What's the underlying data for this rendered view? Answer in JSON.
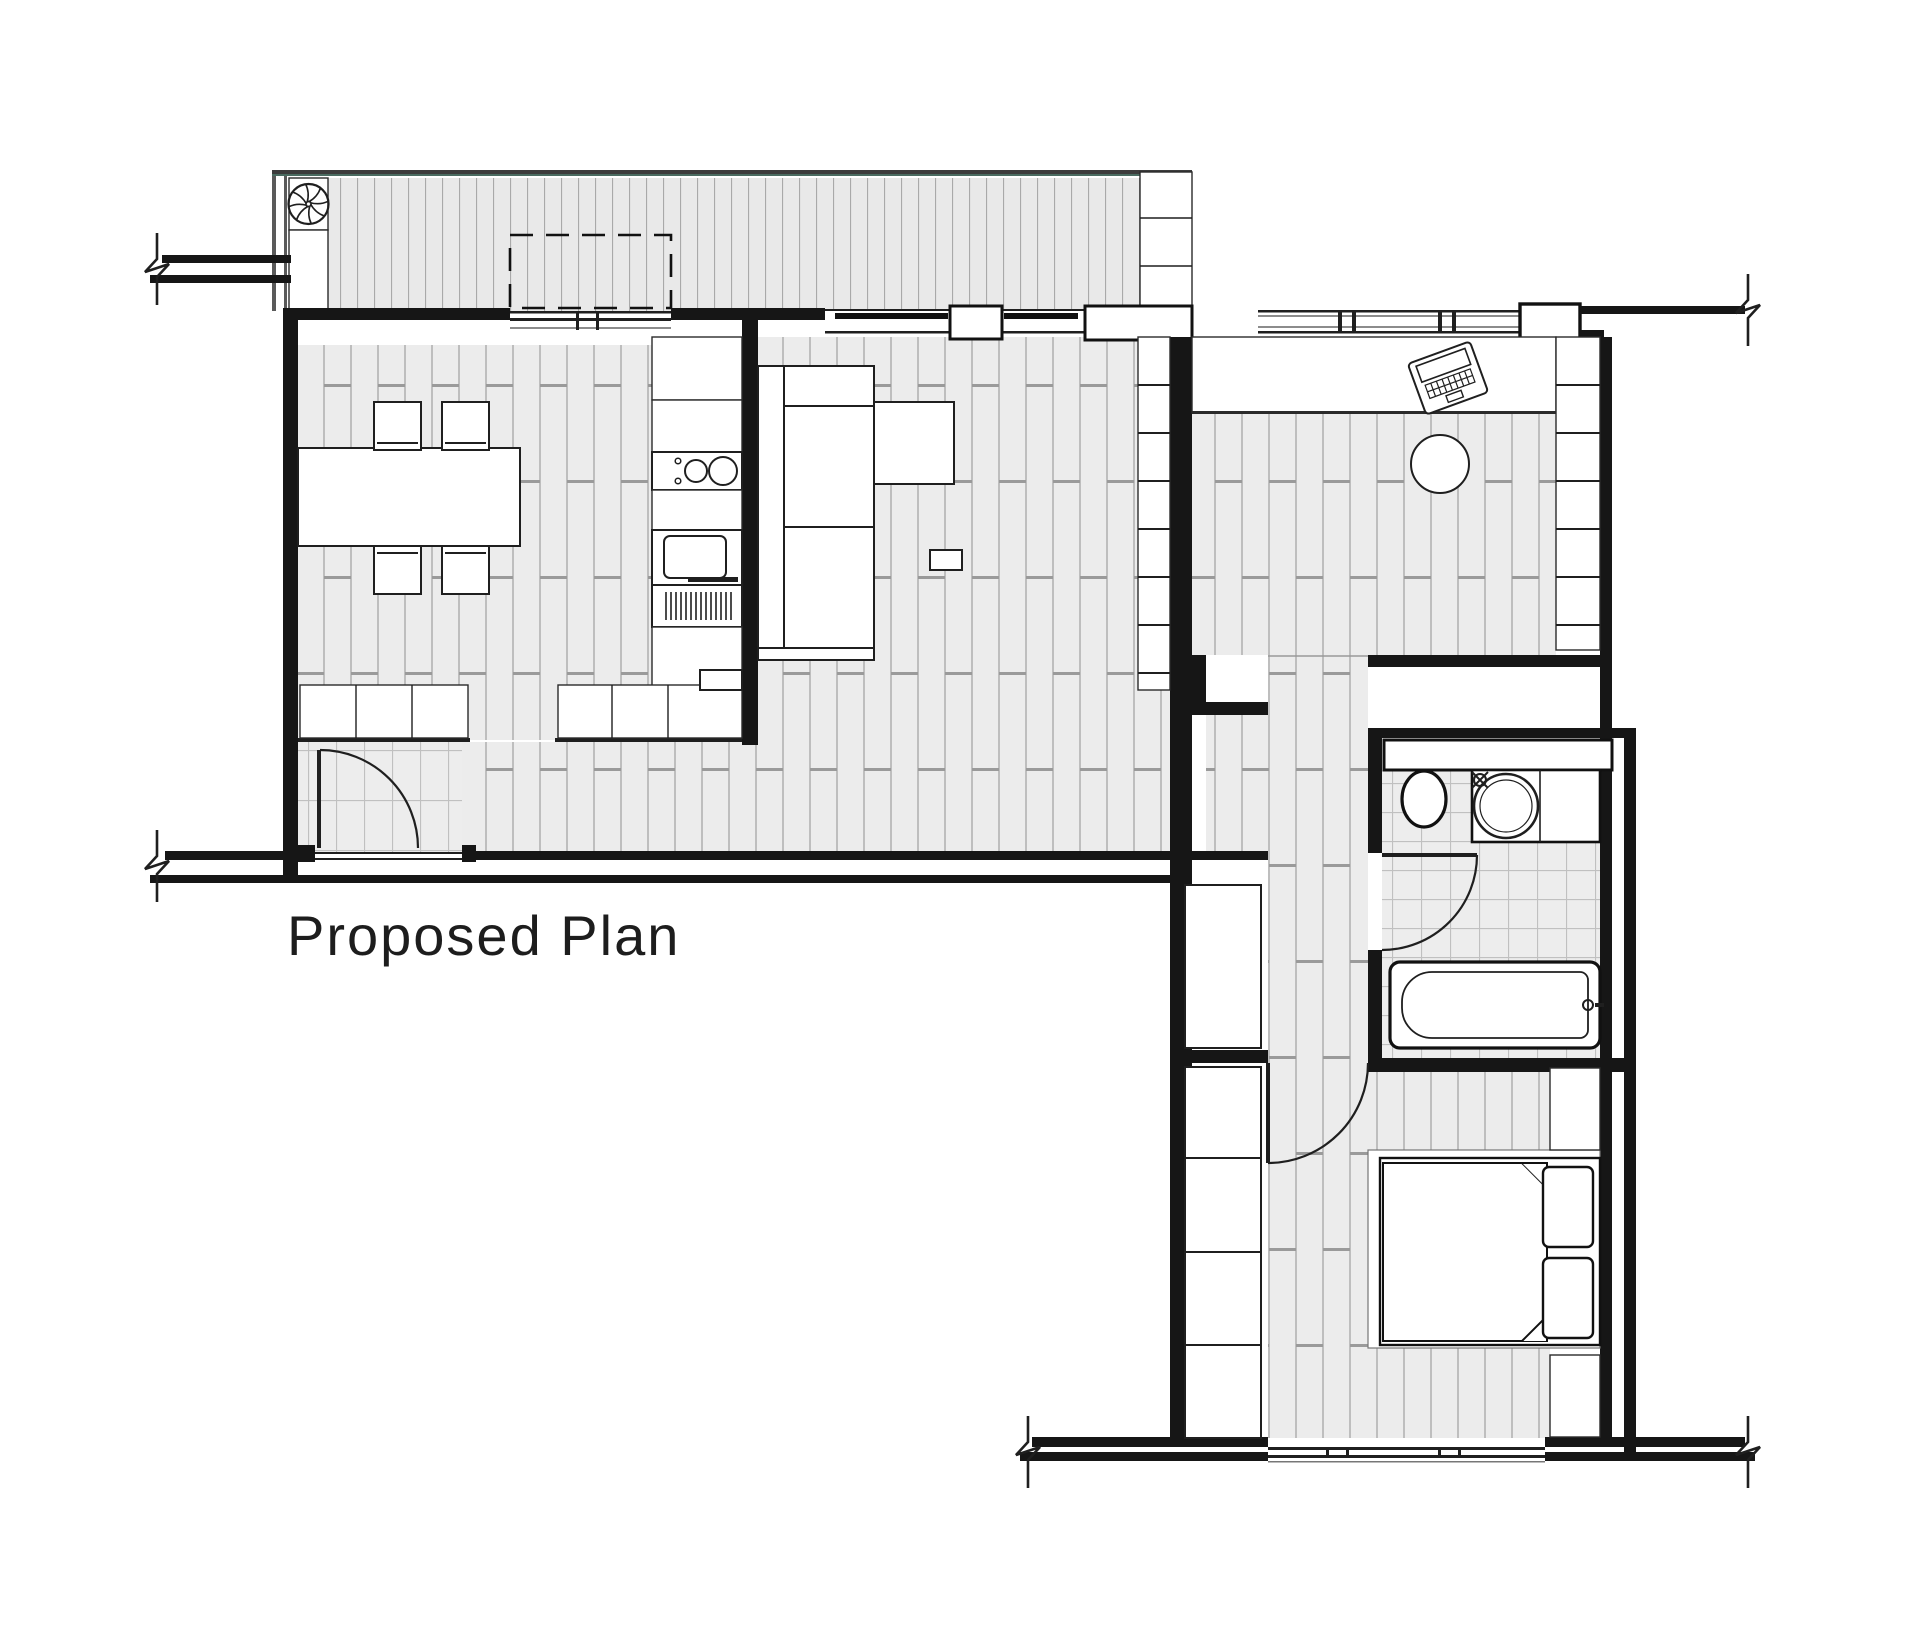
{
  "title": {
    "text": "Proposed Plan"
  },
  "canvas": {
    "width": 1920,
    "height": 1637,
    "background": "#ffffff"
  },
  "colors": {
    "wall": "#161616",
    "line": "#222222",
    "floor": "#ececec",
    "floorJoint": "#b3b3b3",
    "floorJointDark": "#9a9a9a",
    "deck": "#e9e9e9",
    "deckJoint": "#a9a9a9",
    "tile": "#ededed",
    "tileJoint": "#c0c0c0",
    "accent": "#4a6b60",
    "fixture": "#ffffff"
  },
  "legend": {
    "fixtures": [
      "extractor-fan",
      "terrace-deck",
      "roof-overhang-dashed",
      "dining-table",
      "dining-chair",
      "cooktop",
      "oven",
      "vent-grill",
      "kitchen-cabinets",
      "entry-door",
      "sofa",
      "side-table",
      "wall-shelving",
      "desk",
      "laptop",
      "stool",
      "toilet",
      "basin",
      "bathtub",
      "bathroom-door",
      "bedroom-door",
      "wardrobe",
      "bed",
      "pillow",
      "rug",
      "bedside-unit",
      "window",
      "wall-break"
    ]
  }
}
